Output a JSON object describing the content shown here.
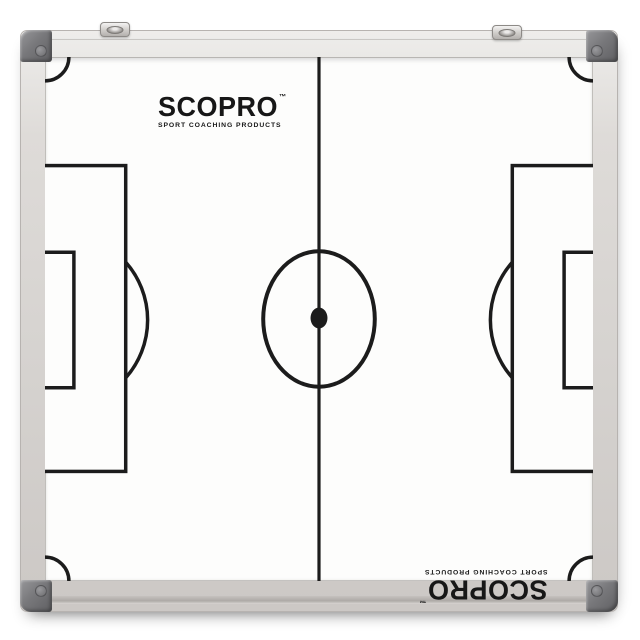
{
  "logo": {
    "brand": "SCOPRO",
    "tm": "™",
    "tagline": "SPORT COACHING PRODUCTS"
  },
  "colors": {
    "pitch_line": "#1c1c1c",
    "board_white": "#fdfdfc",
    "frame_silver": "#d6d3d0",
    "corner_cap": "#757578",
    "background": "#ffffff",
    "logo_ink": "#171717"
  }
}
